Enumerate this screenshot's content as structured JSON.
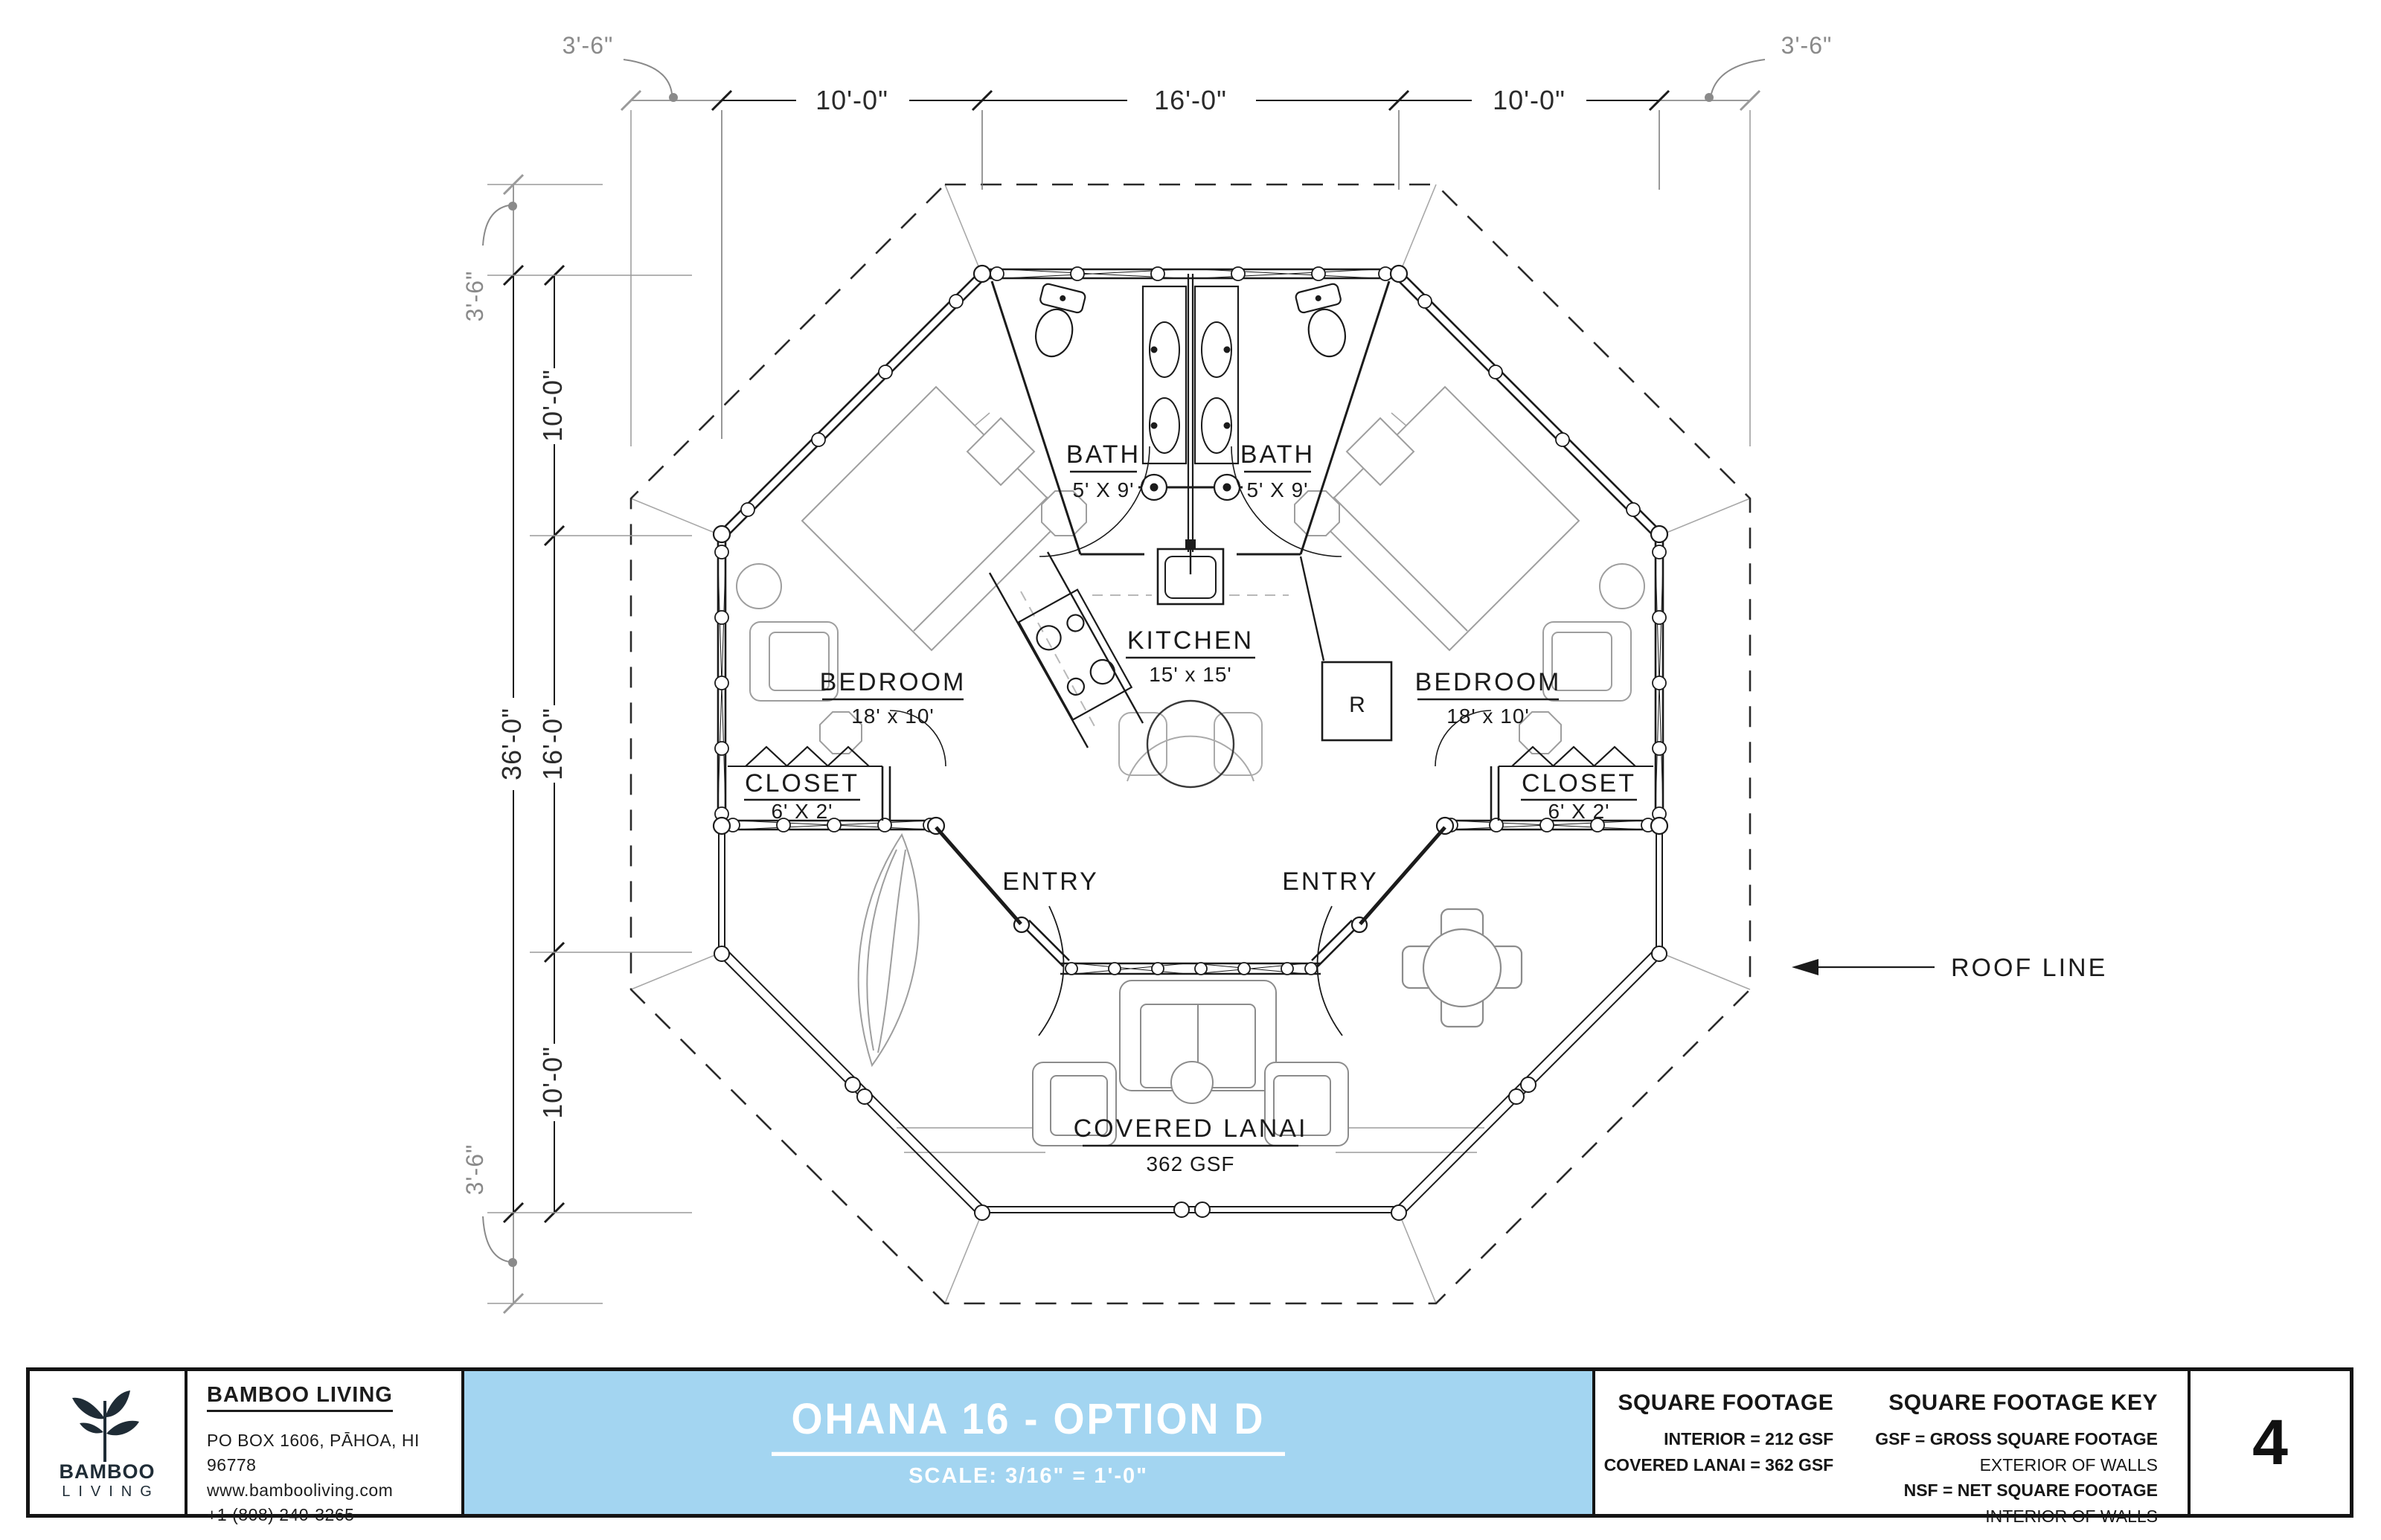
{
  "drawing": {
    "dim_top": [
      "3'-6\"",
      "10'-0\"",
      "16'-0\"",
      "10'-0\"",
      "3'-6\""
    ],
    "dim_left": {
      "overall": "36'-0\"",
      "overhang_top": "3'-6\"",
      "segments": [
        "10'-0\"",
        "16'-0\"",
        "10'-0\""
      ],
      "overhang_bottom": "3'-6\""
    },
    "rooms": {
      "bath": {
        "name": "BATH",
        "size": "5' X 9'"
      },
      "kitchen": {
        "name": "KITCHEN",
        "size": "15' x 15'"
      },
      "bedroom": {
        "name": "BEDROOM",
        "size": "18' x 10'"
      },
      "closet": {
        "name": "CLOSET",
        "size": "6' X 2'"
      },
      "lanai": {
        "name": "COVERED LANAI",
        "size": "362 GSF"
      },
      "entry": "ENTRY"
    },
    "annotations": {
      "roof_line": "ROOF LINE",
      "fridge": "R"
    }
  },
  "title_block": {
    "logo": {
      "line1": "BAMBOO",
      "line2": "LIVING"
    },
    "company": {
      "name": "BAMBOO LIVING",
      "address": "PO BOX 1606, PĀHOA, HI 96778",
      "website": "www.bambooliving.com",
      "phone": "+1 (808) 240-3265"
    },
    "title": {
      "name": "OHANA 16 - OPTION D",
      "scale": "SCALE: 3/16\" = 1'-0\""
    },
    "square_footage": {
      "heading": "SQUARE FOOTAGE",
      "lines": [
        "INTERIOR = 212 GSF",
        "COVERED LANAI = 362 GSF"
      ]
    },
    "square_footage_key": {
      "heading": "SQUARE FOOTAGE KEY",
      "gsf_line": "GSF = GROSS SQUARE FOOTAGE",
      "gsf_sub": "EXTERIOR OF WALLS",
      "nsf_line": "NSF = NET SQUARE FOOTAGE",
      "nsf_sub": "INTERIOR OF WALLS"
    },
    "page_number": "4",
    "accent_color": "#a3d5f1"
  }
}
